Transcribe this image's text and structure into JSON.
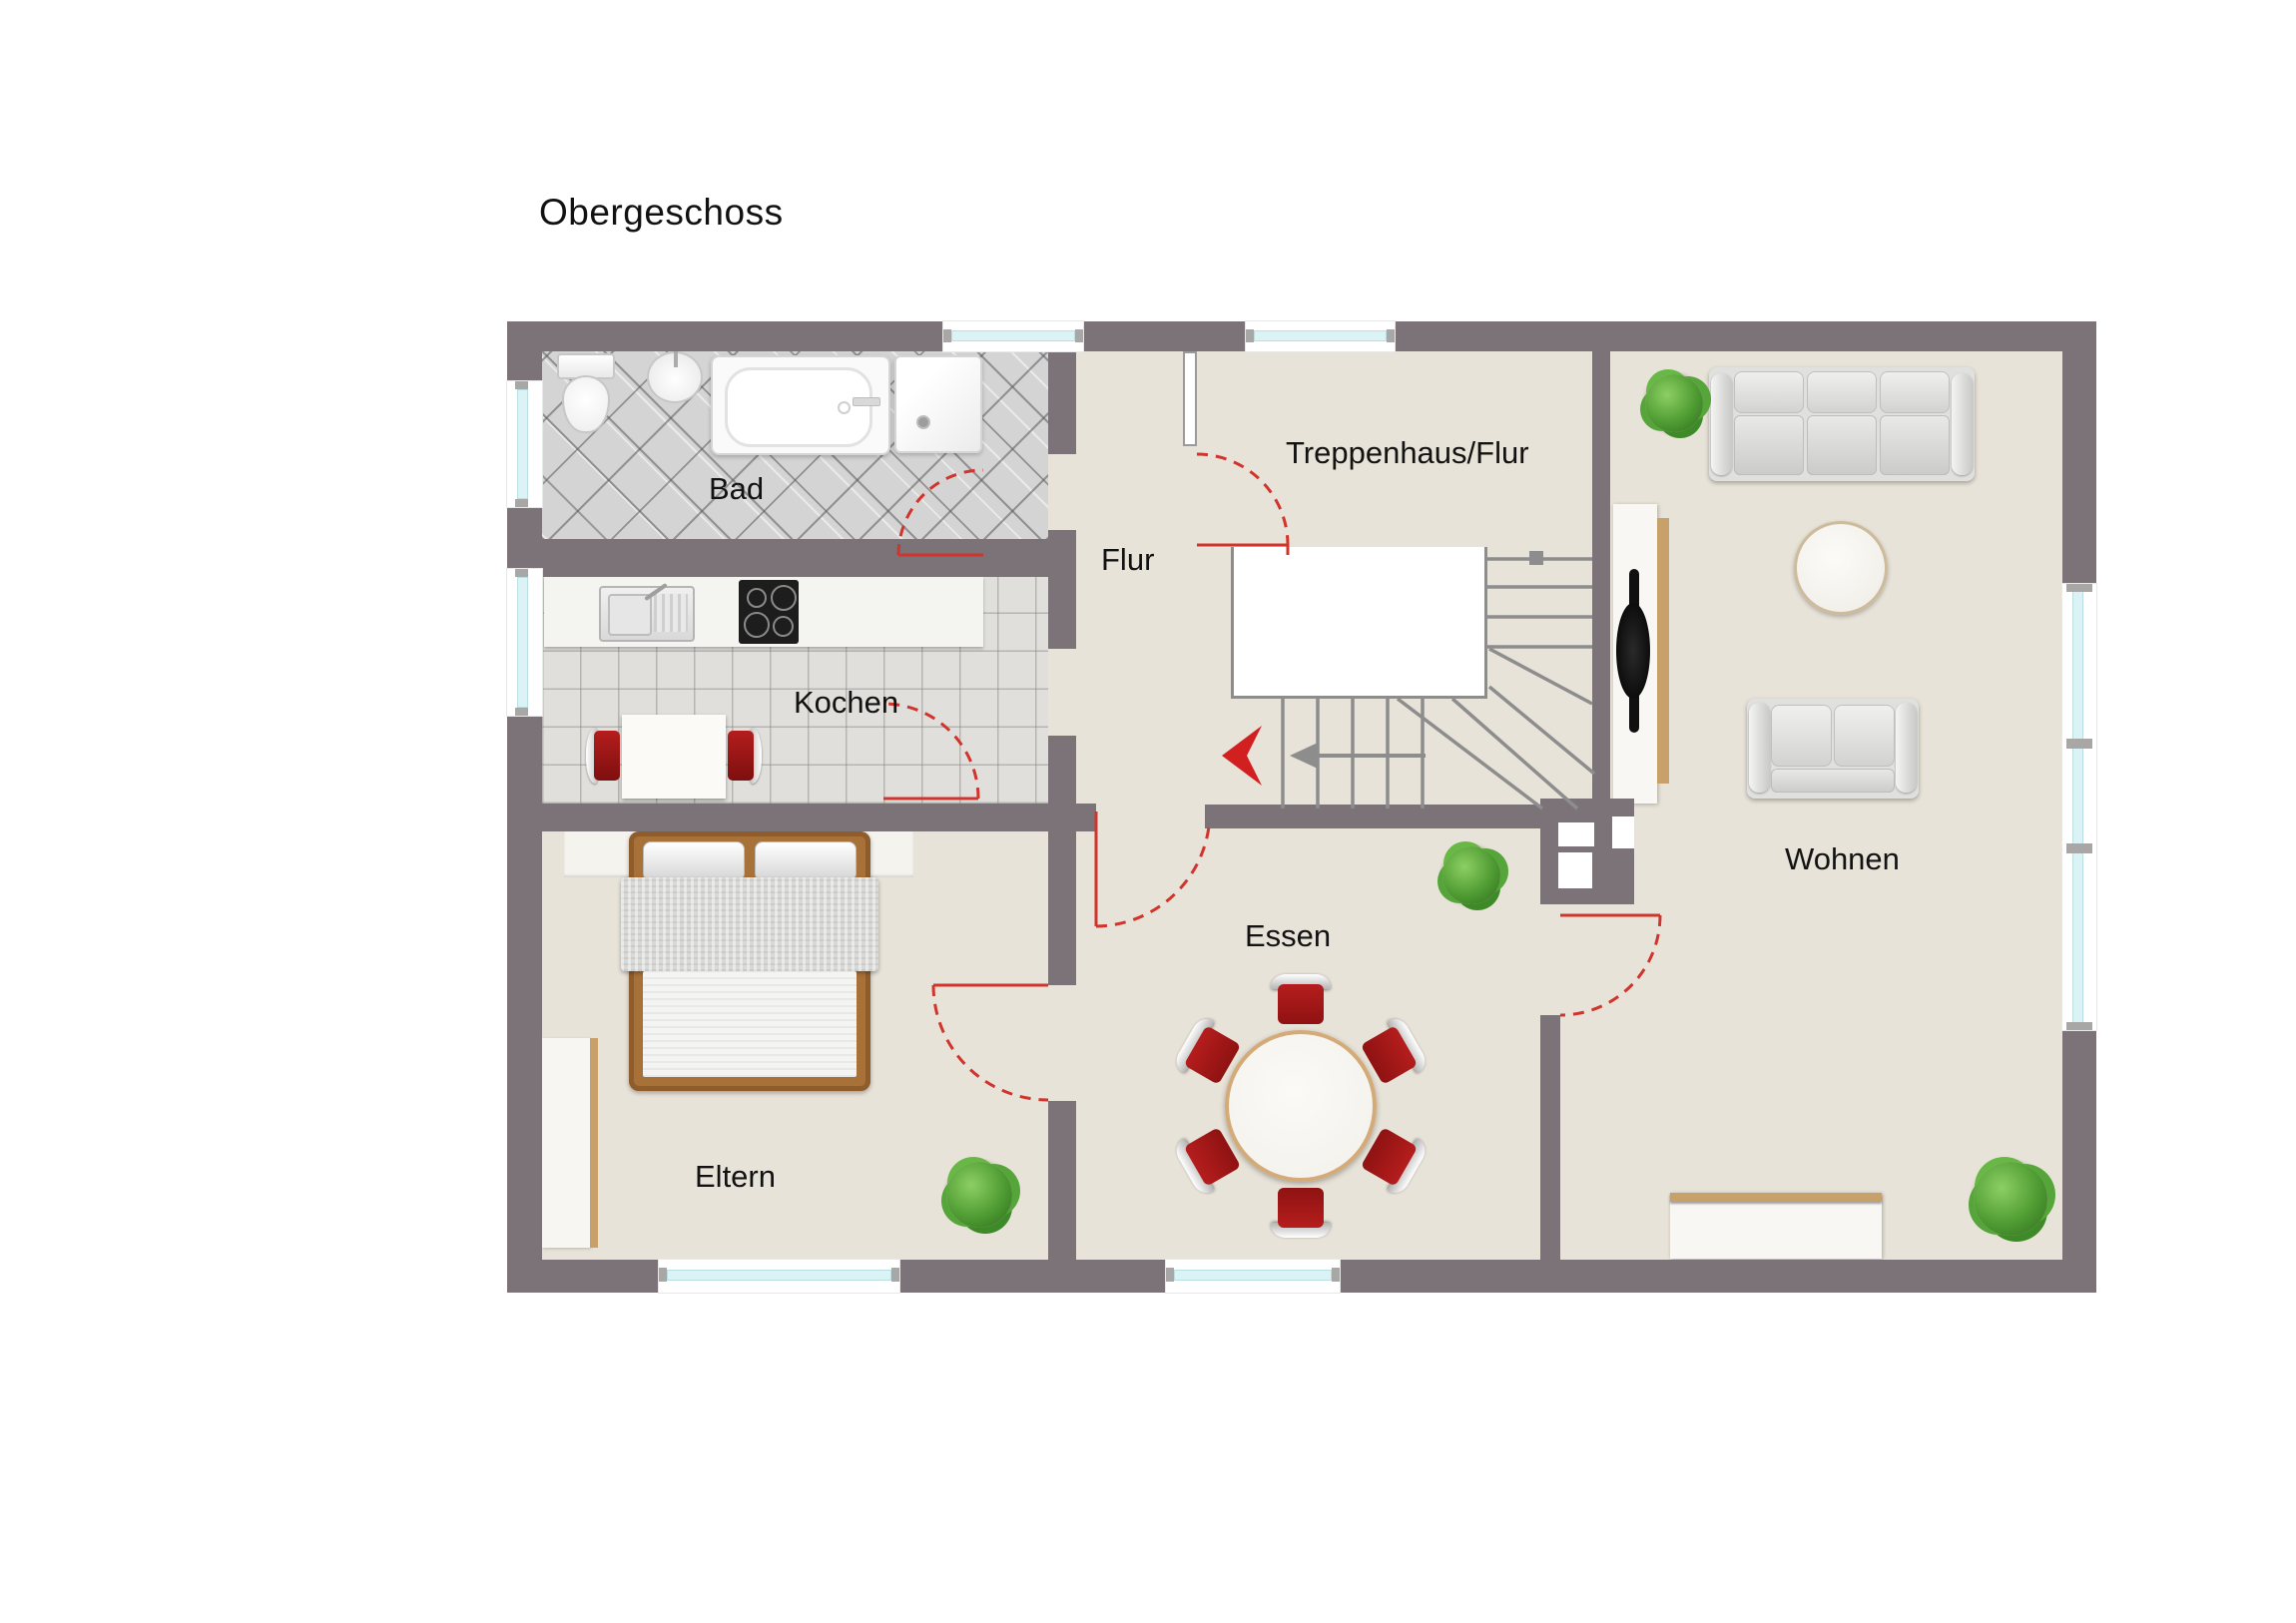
{
  "title": "Obergeschoss",
  "rooms": {
    "bad": {
      "label": "Bad"
    },
    "kochen": {
      "label": "Kochen"
    },
    "flur": {
      "label": "Flur"
    },
    "treppenhaus": {
      "label": "Treppenhaus/Flur"
    },
    "essen": {
      "label": "Essen"
    },
    "wohnen": {
      "label": "Wohnen"
    },
    "eltern": {
      "label": "Eltern"
    }
  },
  "legend_colors": {
    "wall": "#7b7377",
    "floor": "#e8e3d8",
    "bath_tile": "#d4d4d4",
    "kitchen_tile": "#e0dfdb",
    "window_glass": "#dcf3f5",
    "door_red": "#d0342c",
    "chair_red": "#b51d1d",
    "wood": "#a87138",
    "plant_green": "#55a33b",
    "stair_gray": "#8d8d8d"
  }
}
